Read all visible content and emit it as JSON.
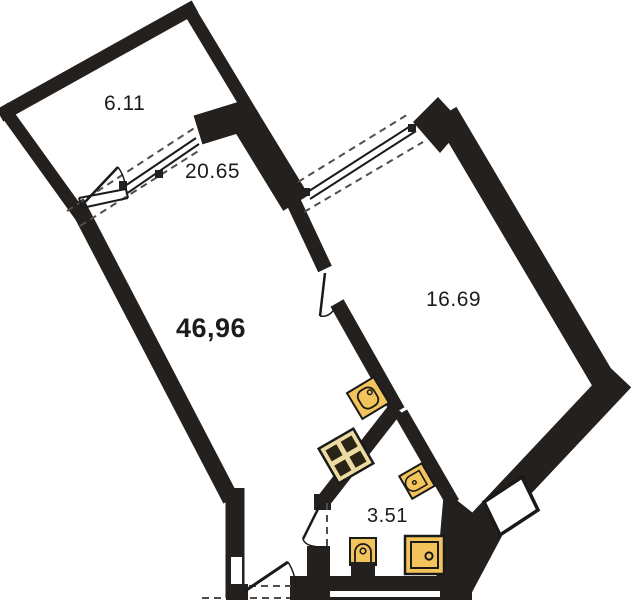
{
  "plan": {
    "type": "apartment-floor-plan",
    "labels": {
      "total_area": "46,96",
      "balcony_area": "6.11",
      "living_room_area": "20.65",
      "bedroom_area": "16.69",
      "bathroom_area": "3.51"
    },
    "rooms": [
      {
        "id": "balcony",
        "area": "6.11"
      },
      {
        "id": "living-room",
        "area": "20.65"
      },
      {
        "id": "bedroom",
        "area": "16.69"
      },
      {
        "id": "bathroom",
        "area": "3.51"
      }
    ],
    "fixtures": [
      "kitchen-sink",
      "stove",
      "washbasin",
      "toilet",
      "washing-machine"
    ],
    "doors": [
      "entrance-door",
      "balcony-door",
      "interior-door",
      "bathroom-door"
    ],
    "windows": [
      "living-room-window",
      "bedroom-window"
    ],
    "colors": {
      "background": "#ffffff",
      "wall": "#24201d",
      "line": "#1a1a1a",
      "dash": "#4d4d4d",
      "fixture_fill": "#f3c45c",
      "stove_fill": "#ecdca2",
      "burner": "#2a2416"
    }
  }
}
